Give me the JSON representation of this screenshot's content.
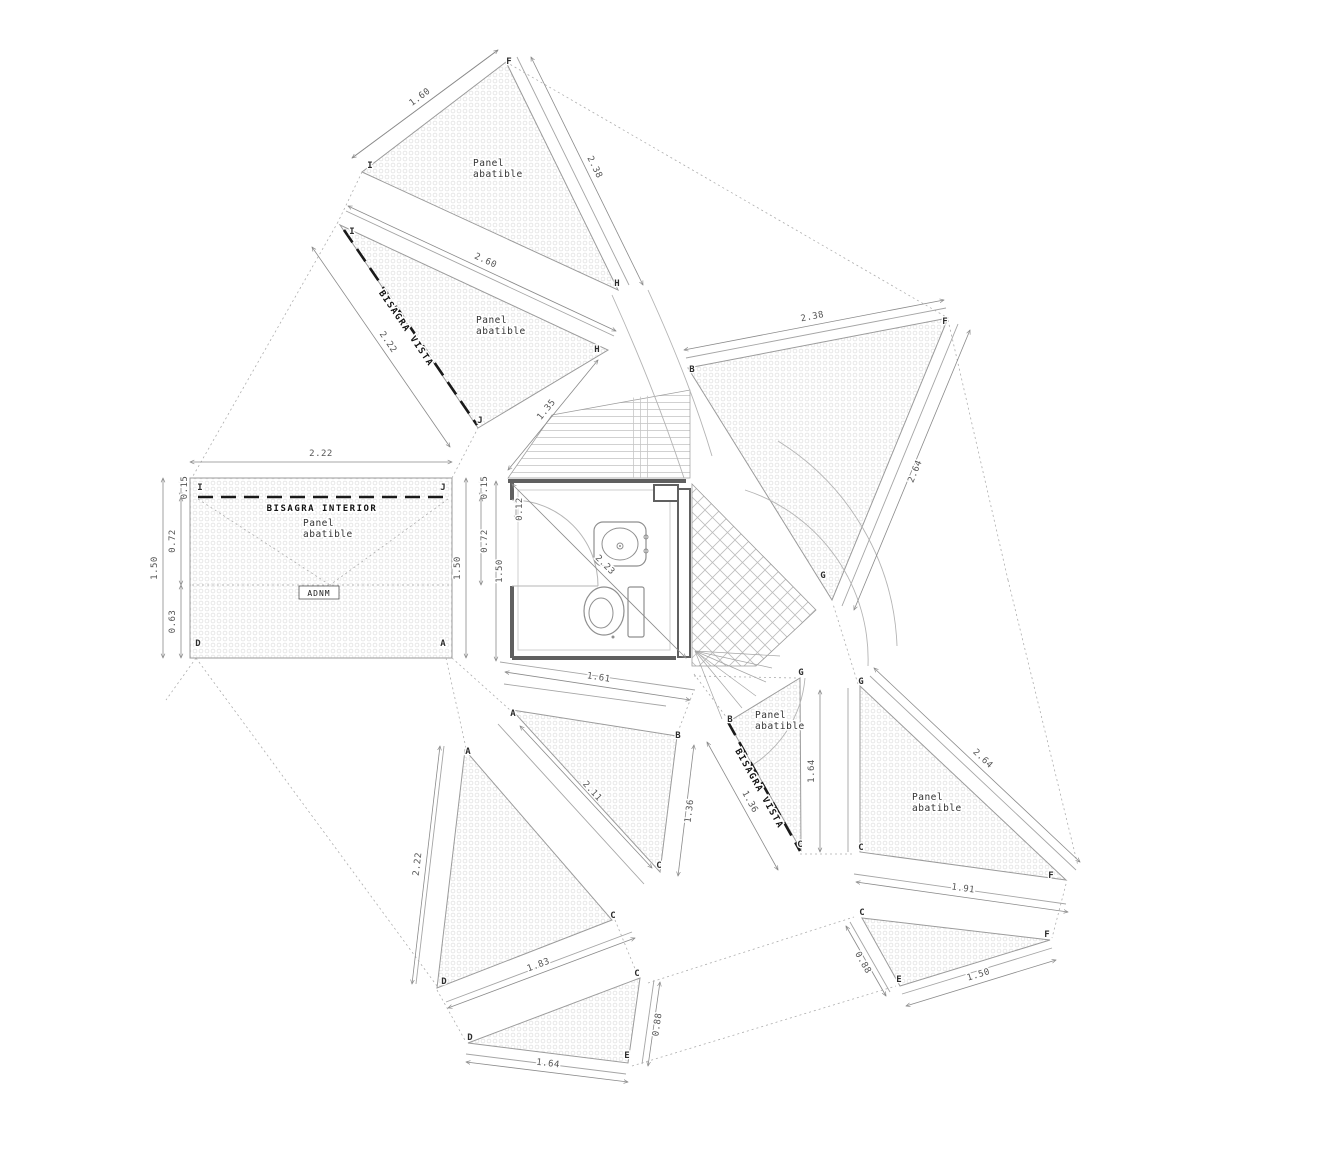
{
  "drawing": {
    "width": 1333,
    "height": 1156,
    "background": "#ffffff",
    "colors": {
      "panel_edge": "#9b9b9b",
      "strip_line": "#a5a5a5",
      "dotted_line": "#adadad",
      "arc_line": "#b4b4b4",
      "dim_line": "#8a8a8a",
      "hinge_line": "#1a1a1a",
      "wall": "#606060",
      "fixture": "#8f8f8f",
      "stipple": "#dfdfdf",
      "hatch": "#c6c6c6"
    },
    "labels": {
      "panel": [
        "Panel",
        "abatible"
      ],
      "panel_positions": [
        [
          473,
          166
        ],
        [
          476,
          323
        ],
        [
          303,
          526
        ],
        [
          755,
          718
        ],
        [
          912,
          800
        ]
      ],
      "bisagra_vista": {
        "text": "BISAGRA VISTA",
        "pos": [
          [
            404,
            330,
            55.7
          ],
          [
            757,
            790,
            60.8
          ]
        ]
      },
      "bisagra_interior": {
        "text": "BISAGRA INTERIOR",
        "pos": [
          322,
          511
        ]
      },
      "badge": {
        "text": "ADNM",
        "box": [
          299,
          586,
          40,
          13
        ],
        "pos": [
          319,
          596
        ]
      }
    },
    "panels": [
      {
        "id": "panel-top",
        "pts": [
          [
            362,
            172
          ],
          [
            506,
            62
          ],
          [
            618,
            290
          ]
        ]
      },
      {
        "id": "panel-upper-left",
        "pts": [
          [
            340,
            225
          ],
          [
            608,
            350
          ],
          [
            478,
            428
          ]
        ]
      },
      {
        "id": "panel-rect-left",
        "pts": [
          [
            190,
            478
          ],
          [
            452,
            478
          ],
          [
            452,
            658
          ],
          [
            190,
            658
          ]
        ]
      },
      {
        "id": "panel-right-big",
        "pts": [
          [
            688,
            368
          ],
          [
            948,
            318
          ],
          [
            832,
            600
          ]
        ]
      },
      {
        "id": "panel-bottom-left",
        "pts": [
          [
            465,
            750
          ],
          [
            612,
            920
          ],
          [
            437,
            988
          ]
        ]
      },
      {
        "id": "panel-center-quad",
        "pts": [
          [
            512,
            710
          ],
          [
            677,
            736
          ],
          [
            660,
            872
          ]
        ]
      },
      {
        "id": "panel-hinge-small",
        "pts": [
          [
            728,
            722
          ],
          [
            800,
            678
          ],
          [
            801,
            850
          ]
        ]
      },
      {
        "id": "panel-bottom-small",
        "pts": [
          [
            468,
            1043
          ],
          [
            640,
            978
          ],
          [
            628,
            1063
          ]
        ]
      },
      {
        "id": "panel-right-lower",
        "pts": [
          [
            860,
            686
          ],
          [
            1066,
            880
          ],
          [
            860,
            852
          ]
        ]
      },
      {
        "id": "panel-bottom-right",
        "pts": [
          [
            862,
            918
          ],
          [
            1050,
            940
          ],
          [
            900,
            986
          ]
        ]
      }
    ],
    "hatch_regions": {
      "hlines": [
        [
          552,
          415
        ],
        [
          690,
          390
        ],
        [
          690,
          478
        ],
        [
          508,
          478
        ]
      ],
      "vlines": [
        [
          630,
          398
        ],
        [
          654,
          395
        ],
        [
          654,
          478
        ],
        [
          630,
          478
        ]
      ],
      "diag": [
        [
          692,
          484
        ],
        [
          816,
          610
        ],
        [
          756,
          666
        ],
        [
          692,
          666
        ]
      ]
    },
    "strips": [
      [
        352,
        158,
        498,
        50
      ],
      [
        517,
        57,
        629,
        285
      ],
      [
        346,
        211,
        614,
        336
      ],
      [
        686,
        358,
        946,
        308
      ],
      [
        958,
        324,
        842,
        606
      ],
      [
        500,
        662,
        695,
        690
      ],
      [
        504,
        684,
        666,
        706
      ],
      [
        498,
        724,
        644,
        884
      ],
      [
        444,
        746,
        416,
        984
      ],
      [
        446,
        1002,
        632,
        932
      ],
      [
        466,
        1054,
        626,
        1074
      ],
      [
        654,
        980,
        642,
        1064
      ],
      [
        870,
        676,
        1076,
        870
      ],
      [
        854,
        874,
        1066,
        904
      ],
      [
        848,
        688,
        848,
        852
      ],
      [
        850,
        922,
        890,
        992
      ],
      [
        902,
        994,
        1052,
        948
      ]
    ],
    "dotted": [
      [
        362,
        172,
        338,
        222
      ],
      [
        338,
        222,
        193,
        476
      ],
      [
        506,
        62,
        948,
        318
      ],
      [
        452,
        478,
        478,
        428
      ],
      [
        196,
        658,
        437,
        986
      ],
      [
        196,
        658,
        166,
        700
      ],
      [
        446,
        658,
        466,
        748
      ],
      [
        452,
        658,
        510,
        710
      ],
      [
        948,
        320,
        1008,
        580
      ],
      [
        1008,
        580,
        1078,
        866
      ],
      [
        648,
        983,
        854,
        917
      ],
      [
        632,
        1066,
        896,
        986
      ],
      [
        694,
        674,
        727,
        718
      ],
      [
        694,
        676,
        796,
        678
      ],
      [
        800,
        854,
        854,
        854
      ],
      [
        858,
        684,
        833,
        604
      ],
      [
        1066,
        884,
        1052,
        938
      ],
      [
        437,
        990,
        466,
        1042
      ],
      [
        615,
        920,
        638,
        976
      ],
      [
        676,
        737,
        694,
        690
      ],
      [
        198,
        499,
        330,
        585
      ],
      [
        448,
        499,
        330,
        585
      ],
      [
        192,
        585,
        450,
        585
      ]
    ],
    "fan": {
      "from": [
        695,
        651
      ],
      "ends": [
        [
          772,
          668
        ],
        [
          766,
          682
        ],
        [
          756,
          696
        ],
        [
          742,
          708
        ],
        [
          722,
          719
        ],
        [
          780,
          656
        ]
      ]
    },
    "arcs": [
      "M745,490 A178,178 0 0 1 868,666",
      "M778,441 A252,252 0 0 1 897,646",
      "M805,678 A115,115 0 0 1 744,770",
      "M612,295 Q655,390 684,478",
      "M648,290 Q690,382 712,456"
    ],
    "hinges": [
      [
        344,
        230,
        477,
        425
      ],
      [
        728,
        722,
        800,
        851
      ],
      [
        198,
        497,
        447,
        497
      ]
    ],
    "dims": [
      {
        "p": [
          352,
          158,
          498,
          50
        ],
        "t": "1.60"
      },
      {
        "p": [
          531,
          57,
          643,
          285
        ],
        "t": "2.38"
      },
      {
        "p": [
          348,
          206,
          616,
          331
        ],
        "t": "2.60"
      },
      {
        "p": [
          312,
          247,
          450,
          447
        ],
        "t": "2.22"
      },
      {
        "p": [
          508,
          470,
          598,
          360
        ],
        "t": "1.35"
      },
      {
        "p": [
          190,
          462,
          452,
          462
        ],
        "t": "2.22"
      },
      {
        "p": [
          163,
          478,
          163,
          658
        ],
        "t": "1.50",
        "o": -6
      },
      {
        "p": [
          181,
          478,
          181,
          497
        ],
        "t": "0.15"
      },
      {
        "p": [
          181,
          497,
          181,
          585
        ],
        "t": "0.72",
        "o": -6
      },
      {
        "p": [
          181,
          585,
          181,
          658
        ],
        "t": "0.63",
        "o": -6
      },
      {
        "p": [
          466,
          478,
          466,
          658
        ],
        "t": "1.50",
        "o": -6
      },
      {
        "p": [
          481,
          478,
          481,
          497
        ],
        "t": "0.15"
      },
      {
        "p": [
          481,
          497,
          481,
          585
        ],
        "t": "0.72"
      },
      {
        "p": [
          496,
          481,
          496,
          661
        ],
        "t": "1.50"
      },
      {
        "p": [
          516,
          498,
          516,
          520
        ],
        "t": "0.12"
      },
      {
        "p": [
          512,
          484,
          686,
          658
        ],
        "t": "2.23"
      },
      {
        "p": [
          505,
          672,
          690,
          700
        ],
        "t": "1.61"
      },
      {
        "p": [
          520,
          726,
          652,
          868
        ],
        "t": "2.11"
      },
      {
        "p": [
          694,
          745,
          678,
          876
        ],
        "t": "1.36"
      },
      {
        "p": [
          707,
          742,
          778,
          870
        ],
        "t": "1.36"
      },
      {
        "p": [
          820,
          690,
          820,
          852
        ],
        "t": "1.64",
        "o": -6
      },
      {
        "p": [
          684,
          350,
          944,
          300
        ],
        "t": "2.38"
      },
      {
        "p": [
          970,
          330,
          854,
          610
        ],
        "t": "2.64"
      },
      {
        "p": [
          874,
          668,
          1080,
          862
        ],
        "t": "2.64"
      },
      {
        "p": [
          856,
          882,
          1068,
          912
        ],
        "t": "1.91"
      },
      {
        "p": [
          440,
          746,
          412,
          984
        ],
        "t": "2.22",
        "o": -6
      },
      {
        "p": [
          448,
          1008,
          635,
          938
        ],
        "t": "1.83"
      },
      {
        "p": [
          466,
          1062,
          628,
          1082
        ],
        "t": "1.64"
      },
      {
        "p": [
          660,
          982,
          648,
          1066
        ],
        "t": "0.88"
      },
      {
        "p": [
          846,
          926,
          886,
          996
        ],
        "t": "0.88",
        "o": -6
      },
      {
        "p": [
          906,
          1006,
          1056,
          960
        ],
        "t": "1.50"
      }
    ],
    "letters": [
      {
        "t": "I",
        "x": 370,
        "y": 168
      },
      {
        "t": "F",
        "x": 509,
        "y": 64
      },
      {
        "t": "H",
        "x": 617,
        "y": 286
      },
      {
        "t": "I",
        "x": 352,
        "y": 234
      },
      {
        "t": "H",
        "x": 597,
        "y": 352
      },
      {
        "t": "J",
        "x": 480,
        "y": 423
      },
      {
        "t": "I",
        "x": 200,
        "y": 490
      },
      {
        "t": "J",
        "x": 443,
        "y": 490
      },
      {
        "t": "D",
        "x": 198,
        "y": 646
      },
      {
        "t": "A",
        "x": 443,
        "y": 646
      },
      {
        "t": "B",
        "x": 692,
        "y": 372
      },
      {
        "t": "F",
        "x": 945,
        "y": 324
      },
      {
        "t": "G",
        "x": 823,
        "y": 578
      },
      {
        "t": "A",
        "x": 513,
        "y": 716
      },
      {
        "t": "B",
        "x": 678,
        "y": 738
      },
      {
        "t": "C",
        "x": 659,
        "y": 868
      },
      {
        "t": "A",
        "x": 468,
        "y": 754
      },
      {
        "t": "C",
        "x": 613,
        "y": 918
      },
      {
        "t": "D",
        "x": 444,
        "y": 984
      },
      {
        "t": "D",
        "x": 470,
        "y": 1040
      },
      {
        "t": "C",
        "x": 637,
        "y": 976
      },
      {
        "t": "E",
        "x": 627,
        "y": 1058
      },
      {
        "t": "B",
        "x": 730,
        "y": 722
      },
      {
        "t": "C",
        "x": 800,
        "y": 847
      },
      {
        "t": "G",
        "x": 801,
        "y": 675
      },
      {
        "t": "G",
        "x": 861,
        "y": 684
      },
      {
        "t": "C",
        "x": 861,
        "y": 850
      },
      {
        "t": "F",
        "x": 1051,
        "y": 878
      },
      {
        "t": "C",
        "x": 862,
        "y": 915
      },
      {
        "t": "E",
        "x": 899,
        "y": 982
      },
      {
        "t": "F",
        "x": 1047,
        "y": 937
      }
    ],
    "bathroom": {
      "walls": [
        [
          508,
          481,
          686,
          481
        ],
        [
          512,
          658,
          676,
          658
        ],
        [
          512,
          481,
          512,
          500
        ],
        [
          512,
          586,
          512,
          658
        ]
      ],
      "inner_rect": [
        518,
        490,
        152,
        160
      ],
      "right_bar": [
        678,
        489,
        12,
        168
      ],
      "niche": [
        654,
        485,
        24,
        16
      ],
      "door_arc": "M512,500 A86,86 0 0 1 598,586",
      "door_line": [
        512,
        586,
        598,
        586
      ],
      "diag_line": [
        512,
        484,
        686,
        658
      ],
      "sink": {
        "counter": [
          594,
          522,
          52,
          44
        ],
        "basin": [
          620,
          544,
          18,
          16
        ],
        "drain": [
          620,
          546
        ],
        "faucet": [
          [
            646,
            537
          ],
          [
            646,
            551
          ]
        ]
      },
      "toilet": {
        "bowl": [
          604,
          611,
          20,
          24
        ],
        "inner": [
          601,
          613,
          12,
          15
        ],
        "tank": [
          628,
          587,
          16,
          50
        ],
        "dot": [
          613,
          637
        ]
      }
    }
  }
}
